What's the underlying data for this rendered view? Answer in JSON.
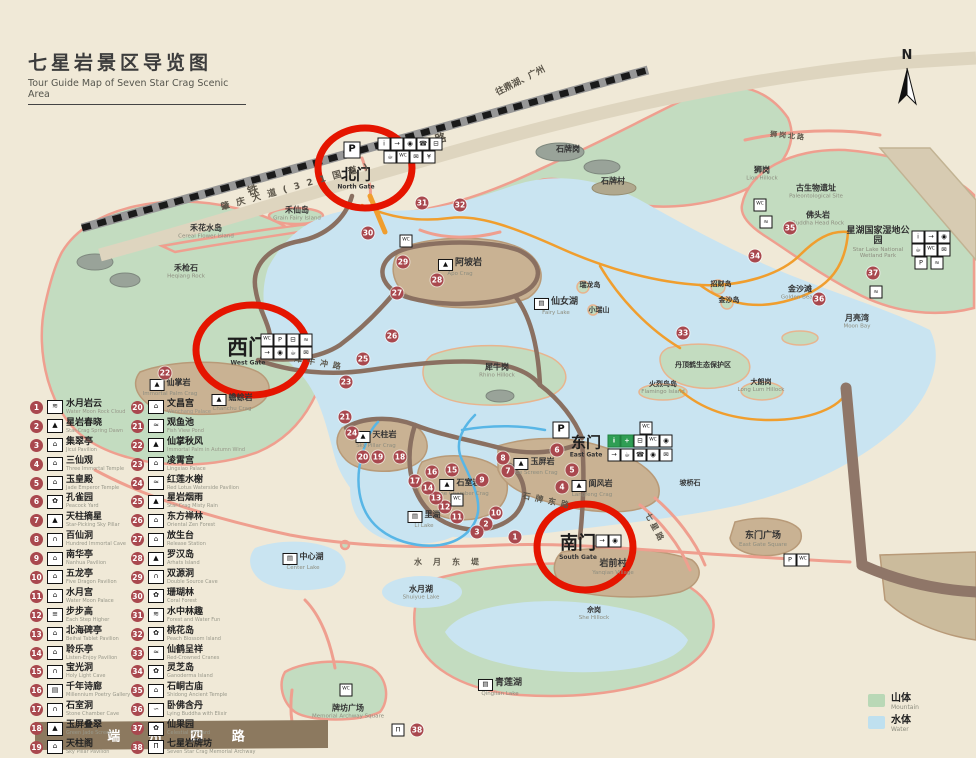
{
  "title": {
    "cn": "七星岩景区导览图",
    "en": "Tour Guide Map of Seven Star Crag Scenic Area"
  },
  "compass": {
    "label": "N"
  },
  "colors": {
    "paper": "#f0e9d7",
    "mountain": "#c3dcc0",
    "water": "#c9e4f1",
    "crag": "#c9b293",
    "trail": "#8a7061",
    "road_salmon": "#ef9f8f",
    "route_orange": "#f09e2e",
    "stream_blue": "#58b6e6",
    "marker": "#a9484e",
    "gate_circle": "#e51500",
    "road_band": "#8c795f"
  },
  "gates": {
    "north": {
      "cn": "北门",
      "en": "North Gate"
    },
    "west": {
      "cn": "西门",
      "en": "West Gate"
    },
    "south": {
      "cn": "南门",
      "en": "South Gate"
    },
    "east": {
      "cn": "东门",
      "en": "East Gate"
    }
  },
  "map_key": {
    "mountain_cn": "山体",
    "mountain_en": "Mountain",
    "water_cn": "水体",
    "water_en": "Water"
  },
  "legend": {
    "col1": [
      {
        "num": "1",
        "cn": "水月岩云",
        "en": "Water Moon Rock Cloud",
        "icon": "scenery-icon",
        "glyph": "≋"
      },
      {
        "num": "2",
        "cn": "星岩春晓",
        "en": "Star-Crag Spring Dawn",
        "icon": "crag-icon",
        "glyph": "▲"
      },
      {
        "num": "3",
        "cn": "集翠亭",
        "en": "Jicui Pavilion",
        "icon": "pavilion-icon",
        "glyph": "⌂"
      },
      {
        "num": "4",
        "cn": "三仙观",
        "en": "Three Immortal Temple",
        "icon": "temple-icon",
        "glyph": "⌂"
      },
      {
        "num": "5",
        "cn": "玉皇殿",
        "en": "Jade Emperor Temple",
        "icon": "temple-icon",
        "glyph": "⌂"
      },
      {
        "num": "6",
        "cn": "孔雀园",
        "en": "Peacock Yard",
        "icon": "garden-icon",
        "glyph": "✿"
      },
      {
        "num": "7",
        "cn": "天柱摘星",
        "en": "Star-Picking Sky Pillar",
        "icon": "pillar-icon",
        "glyph": "▲"
      },
      {
        "num": "8",
        "cn": "百仙洞",
        "en": "Hundred Immortal Cave",
        "icon": "cave-icon",
        "glyph": "∩"
      },
      {
        "num": "9",
        "cn": "南华亭",
        "en": "Nanhua Pavilion",
        "icon": "pavilion-icon",
        "glyph": "⌂"
      },
      {
        "num": "10",
        "cn": "五龙亭",
        "en": "Five Dragon Pavilion",
        "icon": "pavilion-icon",
        "glyph": "⌂"
      },
      {
        "num": "11",
        "cn": "水月宫",
        "en": "Water Moon Palace",
        "icon": "temple-icon",
        "glyph": "⌂"
      },
      {
        "num": "12",
        "cn": "步步高",
        "en": "Each Step Higher",
        "icon": "steps-icon",
        "glyph": "≡"
      },
      {
        "num": "13",
        "cn": "北海碑亭",
        "en": "Beihai Tablet Pavilion",
        "icon": "pavilion-icon",
        "glyph": "⌂"
      },
      {
        "num": "14",
        "cn": "聆乐亭",
        "en": "Listen-Enjoy Pavilion",
        "icon": "pavilion-icon",
        "glyph": "⌂"
      },
      {
        "num": "15",
        "cn": "宝光洞",
        "en": "Holy Light Cave",
        "icon": "cave-icon",
        "glyph": "∩"
      },
      {
        "num": "16",
        "cn": "千年诗廊",
        "en": "Millennium Poetry Gallery",
        "icon": "gallery-icon",
        "glyph": "▤"
      },
      {
        "num": "17",
        "cn": "石室洞",
        "en": "Stone Chamber Cave",
        "icon": "cave-icon",
        "glyph": "∩"
      },
      {
        "num": "18",
        "cn": "玉屏叠翠",
        "en": "Green Jade Screen",
        "icon": "ridge-icon",
        "glyph": "▲"
      },
      {
        "num": "19",
        "cn": "天柱阁",
        "en": "Sky Pillar Pavilion",
        "icon": "tower-icon",
        "glyph": "⌂"
      }
    ],
    "col2": [
      {
        "num": "20",
        "cn": "文昌宫",
        "en": "Wenchang Palace",
        "icon": "temple-icon",
        "glyph": "⌂"
      },
      {
        "num": "21",
        "cn": "观鱼池",
        "en": "Fish View Pond",
        "icon": "pond-icon",
        "glyph": "≈"
      },
      {
        "num": "22",
        "cn": "仙掌秋风",
        "en": "Immortal Palm in Autumn Wind",
        "icon": "crag-icon",
        "glyph": "▲"
      },
      {
        "num": "23",
        "cn": "凌霄宫",
        "en": "Lingxiao Palace",
        "icon": "temple-icon",
        "glyph": "⌂"
      },
      {
        "num": "24",
        "cn": "红莲水榭",
        "en": "Red Lotus Waterside Pavilion",
        "icon": "pond-icon",
        "glyph": "≈"
      },
      {
        "num": "25",
        "cn": "星岩烟雨",
        "en": "Star-Crag Misty Rain",
        "icon": "crag-icon",
        "glyph": "▲"
      },
      {
        "num": "26",
        "cn": "东方禅林",
        "en": "Oriental Zen Forest",
        "icon": "temple-icon",
        "glyph": "⌂"
      },
      {
        "num": "27",
        "cn": "放生台",
        "en": "Release Station",
        "icon": "platform-icon",
        "glyph": "⌂"
      },
      {
        "num": "28",
        "cn": "罗汉岛",
        "en": "Arhats Island",
        "icon": "island-icon",
        "glyph": "▲"
      },
      {
        "num": "29",
        "cn": "双源洞",
        "en": "Double Source Cave",
        "icon": "cave-icon",
        "glyph": "∩"
      },
      {
        "num": "30",
        "cn": "珊瑚林",
        "en": "Coral Forest",
        "icon": "forest-icon",
        "glyph": "✿"
      },
      {
        "num": "31",
        "cn": "水中林趣",
        "en": "Forest and Water Fun",
        "icon": "scenery-icon",
        "glyph": "≋"
      },
      {
        "num": "32",
        "cn": "桃花岛",
        "en": "Peach Blossom Island",
        "icon": "island-icon",
        "glyph": "✿"
      },
      {
        "num": "33",
        "cn": "仙鹤呈祥",
        "en": "Red-Crowned Cranes",
        "icon": "crane-icon",
        "glyph": "≈"
      },
      {
        "num": "34",
        "cn": "灵芝岛",
        "en": "Ganoderma Island",
        "icon": "island-icon",
        "glyph": "✿"
      },
      {
        "num": "35",
        "cn": "石峒古庙",
        "en": "Shidong Ancient Temple",
        "icon": "temple-icon",
        "glyph": "⌂"
      },
      {
        "num": "36",
        "cn": "卧佛含丹",
        "en": "Lying Buddha with Elixir",
        "icon": "buddha-icon",
        "glyph": "∽"
      },
      {
        "num": "37",
        "cn": "仙果园",
        "en": "Celestial Orchard",
        "icon": "orchard-icon",
        "glyph": "✿"
      },
      {
        "num": "38",
        "cn": "七星岩牌坊",
        "en": "Seven Star Crag Memorial Archway",
        "icon": "archway-icon",
        "glyph": "Π"
      }
    ]
  },
  "places": [
    {
      "cn": "禾花水岛",
      "en": "Cereal Flower Island",
      "x": 206,
      "y": 232,
      "fs": 8
    },
    {
      "cn": "禾仙岛",
      "en": "Grain Fairy Island",
      "x": 297,
      "y": 214,
      "fs": 8
    },
    {
      "cn": "禾枪石",
      "en": "Heqiang Rock",
      "x": 186,
      "y": 272,
      "fs": 8
    },
    {
      "cn": "阿坡岩",
      "en": "Apo Crag",
      "x": 460,
      "y": 268,
      "glyph": "▲"
    },
    {
      "cn": "仙掌岩",
      "en": "Immortal Palm Crag",
      "x": 170,
      "y": 388,
      "glyph": "▲",
      "fs": 8
    },
    {
      "cn": "蟾蜍岩",
      "en": "Chanchu Crag",
      "x": 232,
      "y": 403,
      "glyph": "▲",
      "fs": 8
    },
    {
      "cn": "天柱岩",
      "en": "Sky Pillar Crag",
      "x": 376,
      "y": 440,
      "glyph": "▲",
      "fs": 8
    },
    {
      "cn": "石室岩",
      "en": "Stone Chamber Crag",
      "x": 460,
      "y": 488,
      "glyph": "▲",
      "fs": 8
    },
    {
      "cn": "玉屏岩",
      "en": "Jade Screen Crag",
      "x": 534,
      "y": 467,
      "glyph": "▲",
      "fs": 8
    },
    {
      "cn": "阆风岩",
      "en": "Langfeng Crag",
      "x": 592,
      "y": 489,
      "glyph": "▲",
      "fs": 8
    },
    {
      "cn": "犀牛岗",
      "en": "Rhino Hillock",
      "x": 497,
      "y": 371,
      "fs": 8
    },
    {
      "cn": "仙女湖",
      "en": "Fairy Lake",
      "x": 556,
      "y": 307,
      "glyph": "▤"
    },
    {
      "cn": "石牌岗",
      "en": "",
      "x": 568,
      "y": 150,
      "fs": 8
    },
    {
      "cn": "石牌村",
      "en": "",
      "x": 613,
      "y": 182,
      "fs": 8
    },
    {
      "cn": "狮岗",
      "en": "Lion Hillock",
      "x": 762,
      "y": 174,
      "fs": 8
    },
    {
      "cn": "古生物遗址",
      "en": "Paleontological Site",
      "x": 816,
      "y": 192,
      "fs": 8
    },
    {
      "cn": "佛头岩",
      "en": "Buddha Head Rock",
      "x": 818,
      "y": 219,
      "fs": 8
    },
    {
      "cn": "星湖国家湿地公园",
      "en": "Star Lake National Wetland Park",
      "x": 878,
      "y": 243,
      "fs": 9,
      "cls": "wrap",
      "w": 66
    },
    {
      "cn": "金沙滩",
      "en": "Golden Beach",
      "x": 800,
      "y": 293,
      "fs": 8
    },
    {
      "cn": "月亮湾",
      "en": "Moon Bay",
      "x": 857,
      "y": 322,
      "fs": 8
    },
    {
      "cn": "招财岛",
      "en": "",
      "x": 721,
      "y": 285,
      "fs": 7
    },
    {
      "cn": "金沙岛",
      "en": "",
      "x": 729,
      "y": 301,
      "fs": 7
    },
    {
      "cn": "瑞龙岛",
      "en": "",
      "x": 590,
      "y": 286,
      "fs": 7
    },
    {
      "cn": "小瑞山",
      "en": "",
      "x": 599,
      "y": 311,
      "fs": 7
    },
    {
      "cn": "丹顶鹤生态保护区",
      "en": "",
      "x": 703,
      "y": 366,
      "fs": 7,
      "cls": "wrap",
      "w": 58
    },
    {
      "cn": "火烈鸟岛",
      "en": "Flamingo Island",
      "x": 663,
      "y": 388,
      "fs": 7
    },
    {
      "cn": "大朗岗",
      "en": "Long Lum Hillock",
      "x": 761,
      "y": 386,
      "fs": 7
    },
    {
      "cn": "坡桥石",
      "en": "",
      "x": 690,
      "y": 484,
      "fs": 7
    },
    {
      "cn": "里湖",
      "en": "Li Lake",
      "x": 424,
      "y": 520,
      "glyph": "▤",
      "fs": 8
    },
    {
      "cn": "中心湖",
      "en": "Center Lake",
      "x": 303,
      "y": 562,
      "glyph": "▤",
      "fs": 8
    },
    {
      "cn": "水月湖",
      "en": "Shuiyue Lake",
      "x": 421,
      "y": 593,
      "fs": 8
    },
    {
      "cn": "青莲湖",
      "en": "Qinglian Lake",
      "x": 500,
      "y": 688,
      "glyph": "▤"
    },
    {
      "cn": "岩前村",
      "en": "Yanqian Village",
      "x": 613,
      "y": 568,
      "fs": 9
    },
    {
      "cn": "佘岗",
      "en": "She Hillock",
      "x": 594,
      "y": 614,
      "fs": 7
    },
    {
      "cn": "东门广场",
      "en": "East Gate Square",
      "x": 763,
      "y": 540,
      "fs": 9
    },
    {
      "cn": "牌坊广场",
      "en": "Memorial Archway Square",
      "x": 348,
      "y": 712,
      "fs": 8
    }
  ],
  "road_labels": [
    {
      "text": "铁    路",
      "x": 390,
      "y": 152,
      "rot": -15.5,
      "fs": 11,
      "ls": 90
    },
    {
      "text": "肇 庆 大 道 ( 3 2 1 国 道 )",
      "x": 295,
      "y": 186,
      "rot": -15.5,
      "fs": 9,
      "ls": 2
    },
    {
      "text": "往鼎湖、广州",
      "x": 520,
      "y": 80,
      "rot": -27,
      "fs": 9
    },
    {
      "text": "犀牛冲路",
      "x": 320,
      "y": 363,
      "rot": 10,
      "fs": 8,
      "ls": 5
    },
    {
      "text": "石牌东路",
      "x": 548,
      "y": 501,
      "rot": 12,
      "fs": 8,
      "ls": 5
    },
    {
      "text": "水月东堤",
      "x": 452,
      "y": 562,
      "rot": 0,
      "fs": 8,
      "ls": 11
    },
    {
      "text": "狮岗北路",
      "x": 788,
      "y": 136,
      "rot": 6,
      "fs": 7,
      "ls": 2
    },
    {
      "text": "七星路",
      "x": 655,
      "y": 528,
      "rot": 62,
      "fs": 8,
      "ls": 3
    },
    {
      "text": "端 州 四 路",
      "x": 182,
      "y": 735,
      "fs": 13,
      "ls": 12,
      "cls": "road-white"
    }
  ],
  "markers": [
    {
      "n": "1",
      "x": 515,
      "y": 537
    },
    {
      "n": "2",
      "x": 486,
      "y": 524
    },
    {
      "n": "3",
      "x": 477,
      "y": 532
    },
    {
      "n": "4",
      "x": 562,
      "y": 487
    },
    {
      "n": "5",
      "x": 572,
      "y": 470
    },
    {
      "n": "6",
      "x": 557,
      "y": 450
    },
    {
      "n": "7",
      "x": 508,
      "y": 471
    },
    {
      "n": "8",
      "x": 503,
      "y": 458
    },
    {
      "n": "9",
      "x": 482,
      "y": 480
    },
    {
      "n": "10",
      "x": 496,
      "y": 513
    },
    {
      "n": "11",
      "x": 457,
      "y": 517
    },
    {
      "n": "12",
      "x": 445,
      "y": 507
    },
    {
      "n": "13",
      "x": 436,
      "y": 498
    },
    {
      "n": "14",
      "x": 428,
      "y": 488
    },
    {
      "n": "15",
      "x": 452,
      "y": 470
    },
    {
      "n": "16",
      "x": 432,
      "y": 472
    },
    {
      "n": "17",
      "x": 415,
      "y": 481
    },
    {
      "n": "18",
      "x": 400,
      "y": 457
    },
    {
      "n": "19",
      "x": 378,
      "y": 457
    },
    {
      "n": "20",
      "x": 363,
      "y": 457
    },
    {
      "n": "21",
      "x": 345,
      "y": 417
    },
    {
      "n": "22",
      "x": 165,
      "y": 373
    },
    {
      "n": "23",
      "x": 346,
      "y": 382
    },
    {
      "n": "24",
      "x": 352,
      "y": 433
    },
    {
      "n": "25",
      "x": 363,
      "y": 359
    },
    {
      "n": "26",
      "x": 392,
      "y": 336
    },
    {
      "n": "27",
      "x": 397,
      "y": 293
    },
    {
      "n": "28",
      "x": 437,
      "y": 280
    },
    {
      "n": "29",
      "x": 403,
      "y": 262
    },
    {
      "n": "30",
      "x": 368,
      "y": 233
    },
    {
      "n": "31",
      "x": 422,
      "y": 203
    },
    {
      "n": "32",
      "x": 460,
      "y": 205
    },
    {
      "n": "33",
      "x": 683,
      "y": 333
    },
    {
      "n": "34",
      "x": 755,
      "y": 256
    },
    {
      "n": "35",
      "x": 790,
      "y": 228
    },
    {
      "n": "36",
      "x": 819,
      "y": 299
    },
    {
      "n": "37",
      "x": 873,
      "y": 273
    },
    {
      "n": "38",
      "x": 417,
      "y": 730
    }
  ],
  "facility_icons": [
    {
      "g": "P",
      "x": 352,
      "y": 150,
      "cls": "big",
      "name": "parking-icon"
    },
    {
      "g": "i",
      "x": 384,
      "y": 144,
      "name": "info-icon"
    },
    {
      "g": "→",
      "x": 397,
      "y": 144,
      "name": "exit-icon"
    },
    {
      "g": "◉",
      "x": 410,
      "y": 144,
      "name": "camera-icon"
    },
    {
      "g": "☎",
      "x": 423,
      "y": 144,
      "name": "phone-icon"
    },
    {
      "g": "⊟",
      "x": 436,
      "y": 144,
      "name": "bus-icon"
    },
    {
      "g": "☕",
      "x": 390,
      "y": 157,
      "name": "drink-icon"
    },
    {
      "g": "WC",
      "x": 403,
      "y": 157,
      "cls": "tiny",
      "name": "restroom-icon"
    },
    {
      "g": "✉",
      "x": 416,
      "y": 157,
      "name": "mail-icon"
    },
    {
      "g": "¥",
      "x": 429,
      "y": 157,
      "name": "shop-icon"
    },
    {
      "g": "WC",
      "x": 267,
      "y": 340,
      "cls": "tiny",
      "name": "restroom-icon"
    },
    {
      "g": "P",
      "x": 280,
      "y": 340,
      "name": "parking-icon"
    },
    {
      "g": "⊟",
      "x": 293,
      "y": 340,
      "name": "bus-icon"
    },
    {
      "g": "≈",
      "x": 306,
      "y": 340,
      "name": "boat-icon"
    },
    {
      "g": "→",
      "x": 267,
      "y": 353,
      "name": "exit-icon"
    },
    {
      "g": "◉",
      "x": 280,
      "y": 353,
      "name": "camera-icon"
    },
    {
      "g": "☕",
      "x": 293,
      "y": 353,
      "name": "drink-icon"
    },
    {
      "g": "✉",
      "x": 306,
      "y": 353,
      "name": "mail-icon"
    },
    {
      "g": "P",
      "x": 561,
      "y": 430,
      "cls": "big",
      "name": "parking-icon"
    },
    {
      "g": "i",
      "x": 614,
      "y": 441,
      "cls": "green",
      "name": "info-icon"
    },
    {
      "g": "+",
      "x": 627,
      "y": 441,
      "cls": "green",
      "name": "first-aid-icon"
    },
    {
      "g": "⊟",
      "x": 640,
      "y": 441,
      "name": "bus-icon"
    },
    {
      "g": "WC",
      "x": 653,
      "y": 441,
      "cls": "tiny",
      "name": "restroom-icon"
    },
    {
      "g": "◉",
      "x": 666,
      "y": 441,
      "name": "camera-icon"
    },
    {
      "g": "→",
      "x": 614,
      "y": 455,
      "name": "exit-icon"
    },
    {
      "g": "☕",
      "x": 627,
      "y": 455,
      "name": "drink-icon"
    },
    {
      "g": "☎",
      "x": 640,
      "y": 455,
      "name": "phone-icon"
    },
    {
      "g": "◉",
      "x": 653,
      "y": 455,
      "name": "camera-icon"
    },
    {
      "g": "✉",
      "x": 666,
      "y": 455,
      "name": "mail-icon"
    },
    {
      "g": "→",
      "x": 602,
      "y": 541,
      "name": "exit-icon"
    },
    {
      "g": "◉",
      "x": 615,
      "y": 541,
      "name": "camera-icon"
    },
    {
      "g": "i",
      "x": 918,
      "y": 237,
      "name": "info-icon"
    },
    {
      "g": "→",
      "x": 931,
      "y": 237,
      "name": "exit-icon"
    },
    {
      "g": "◉",
      "x": 944,
      "y": 237,
      "name": "camera-icon"
    },
    {
      "g": "☕",
      "x": 918,
      "y": 250,
      "name": "drink-icon"
    },
    {
      "g": "WC",
      "x": 931,
      "y": 250,
      "cls": "tiny",
      "name": "restroom-icon"
    },
    {
      "g": "✉",
      "x": 944,
      "y": 250,
      "name": "mail-icon"
    },
    {
      "g": "P",
      "x": 921,
      "y": 263,
      "name": "parking-icon"
    },
    {
      "g": "≈",
      "x": 937,
      "y": 263,
      "name": "boat-icon"
    },
    {
      "g": "≈",
      "x": 766,
      "y": 222,
      "name": "boat-icon"
    },
    {
      "g": "≈",
      "x": 876,
      "y": 292,
      "name": "boat-icon"
    },
    {
      "g": "WC",
      "x": 406,
      "y": 241,
      "cls": "tiny",
      "name": "restroom-icon"
    },
    {
      "g": "WC",
      "x": 760,
      "y": 205,
      "cls": "tiny",
      "name": "restroom-icon"
    },
    {
      "g": "WC",
      "x": 646,
      "y": 428,
      "cls": "tiny",
      "name": "restroom-icon"
    },
    {
      "g": "WC",
      "x": 457,
      "y": 500,
      "cls": "tiny",
      "name": "restroom-icon"
    },
    {
      "g": "P",
      "x": 790,
      "y": 560,
      "name": "parking-icon"
    },
    {
      "g": "WC",
      "x": 803,
      "y": 560,
      "cls": "tiny",
      "name": "restroom-icon"
    },
    {
      "g": "WC",
      "x": 346,
      "y": 690,
      "cls": "tiny",
      "name": "restroom-icon"
    },
    {
      "g": "Π",
      "x": 398,
      "y": 730,
      "name": "archway-icon"
    }
  ]
}
